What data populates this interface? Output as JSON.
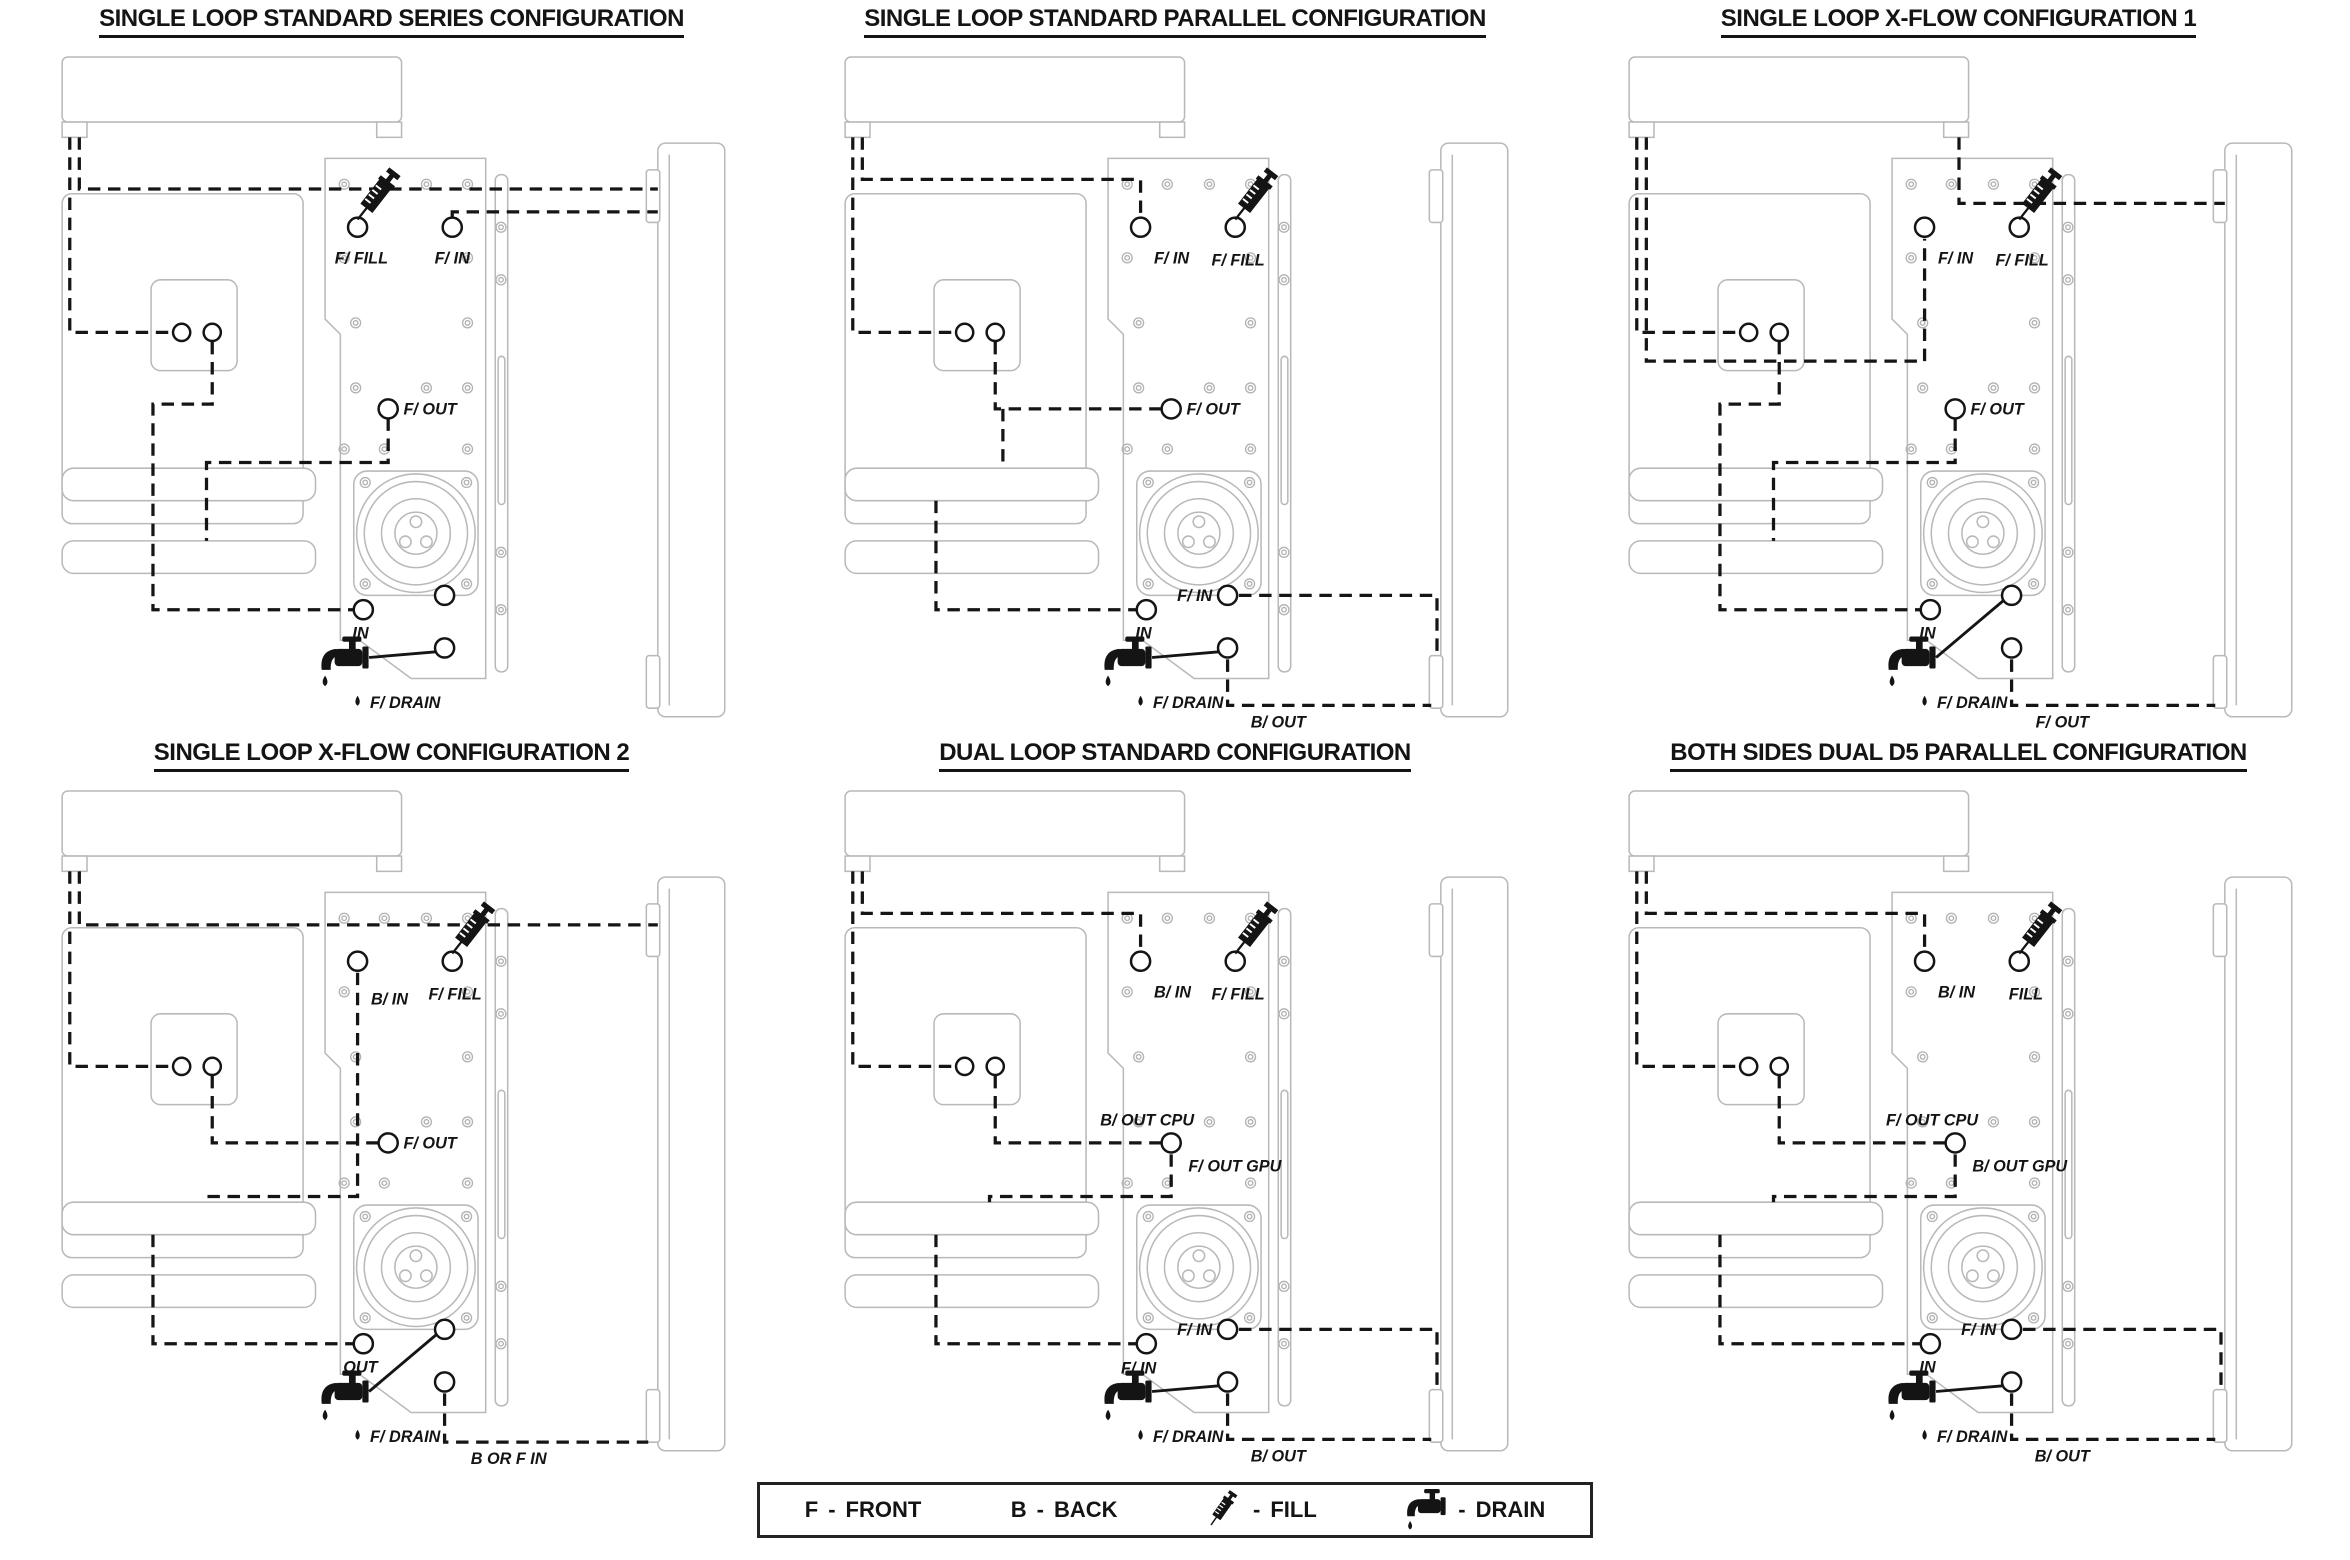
{
  "colors": {
    "background": "#ffffff",
    "case_outline": "#b9b9b9",
    "tubing_line": "#151515"
  },
  "diagrams": [
    {
      "id": "single-loop-standard-series",
      "title": "SINGLE LOOP STANDARD SERIES CONFIGURATION",
      "ports": {
        "top_left": "F/ FILL",
        "top_right": "F/ IN",
        "mid": "F/ OUT",
        "bottom_left": "IN",
        "drain": "F/ DRAIN"
      }
    },
    {
      "id": "single-loop-standard-parallel",
      "title": "SINGLE LOOP STANDARD PARALLEL CONFIGURATION",
      "ports": {
        "top_left": "F/ IN",
        "top_right": "F/ FILL",
        "mid": "F/ OUT",
        "bottom_left": "IN",
        "bottom_right_upper": "F/ IN",
        "bottom_right_lower": "B/ OUT",
        "drain": "F/ DRAIN"
      }
    },
    {
      "id": "single-loop-x-flow-1",
      "title": "SINGLE LOOP X-FLOW CONFIGURATION 1",
      "ports": {
        "top_left": "F/ IN",
        "top_right": "F/ FILL",
        "mid": "F/ OUT",
        "bottom_left": "IN",
        "bottom_right_lower": "F/ OUT",
        "drain": "F/ DRAIN"
      }
    },
    {
      "id": "single-loop-x-flow-2",
      "title": "SINGLE LOOP X-FLOW CONFIGURATION 2",
      "ports": {
        "top_left": "B/ IN",
        "top_right": "F/ FILL",
        "mid": "F/ OUT",
        "bottom_left": "OUT",
        "bottom_right_lower": "B OR F IN",
        "drain": "F/ DRAIN"
      }
    },
    {
      "id": "dual-loop-standard",
      "title": "DUAL LOOP STANDARD CONFIGURATION",
      "ports": {
        "top_left": "B/ IN",
        "top_right": "F/ FILL",
        "mid_upper": "B/ OUT CPU",
        "mid_lower": "F/ OUT GPU",
        "bottom_left": "F/ IN",
        "bottom_right_upper": "F/ IN",
        "bottom_right_lower": "B/ OUT",
        "drain": "F/ DRAIN"
      }
    },
    {
      "id": "both-sides-dual-d5-parallel",
      "title": "BOTH SIDES DUAL D5 PARALLEL CONFIGURATION",
      "ports": {
        "top_left": "B/ IN",
        "top_right": "FILL",
        "mid_upper": "F/ OUT CPU",
        "mid_lower": "B/ OUT GPU",
        "bottom_left": "IN",
        "bottom_right_upper": "F/ IN",
        "bottom_right_lower": "B/ OUT",
        "drain": "F/ DRAIN"
      }
    }
  ],
  "legend": {
    "separator": "-",
    "front": {
      "key": "F",
      "label": "FRONT"
    },
    "back": {
      "key": "B",
      "label": "BACK"
    },
    "fill": {
      "icon": "fill-syringe-icon",
      "label": "FILL"
    },
    "drain": {
      "icon": "drain-faucet-icon",
      "label": "DRAIN"
    }
  }
}
